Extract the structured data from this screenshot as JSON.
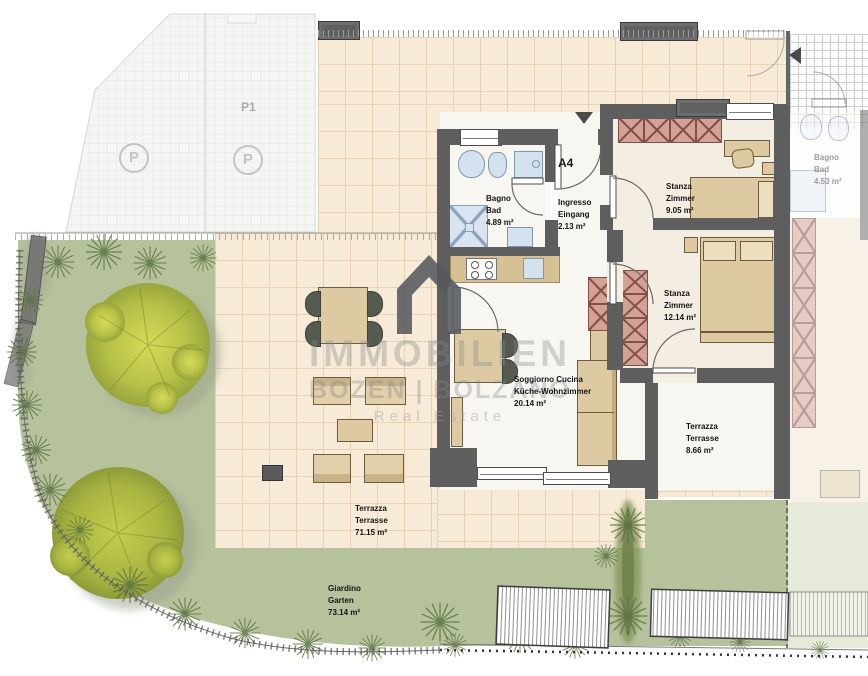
{
  "plan": {
    "unit_label": "A4",
    "parking": {
      "space_label": "P1",
      "icon_letter": "P"
    }
  },
  "watermark": {
    "brand_top": "IMMOBILIEN",
    "brand_bottom": "BOZEN | BOLZANO",
    "tagline": "Real Estate"
  },
  "rooms": {
    "bathroom": {
      "name_it": "Bagno",
      "name_de": "Bad",
      "area": "4.89 m²"
    },
    "entrance": {
      "name_it": "Ingresso",
      "name_de": "Eingang",
      "area": "2.13 m²"
    },
    "bedroom1": {
      "name_it": "Stanza",
      "name_de": "Zimmer",
      "area": "9.05 m²"
    },
    "bedroom2": {
      "name_it": "Stanza",
      "name_de": "Zimmer",
      "area": "12.14 m²"
    },
    "living": {
      "name_it": "Soggiorno Cucina",
      "name_de": "Küche-Wohnzimmer",
      "area": "20.14 m²"
    },
    "terrace_small": {
      "name_it": "Terrazza",
      "name_de": "Terrasse",
      "area": "8.66 m²"
    },
    "terrace_large": {
      "name_it": "Terrazza",
      "name_de": "Terrasse",
      "area": "71.15 m²"
    },
    "garden": {
      "name_it": "Giardino",
      "name_de": "Garten",
      "area": "73.14 m²"
    },
    "neighbor_bathroom": {
      "name_it": "Bagno",
      "name_de": "Bad",
      "area": "4.53 m²"
    }
  },
  "colors": {
    "wall": "#5e5e5e",
    "tile": "#f7ead6",
    "tile_line": "#e7d3b3",
    "garden_green": "#b6c29c",
    "neighbor_green": "#e5ead9",
    "tree_crown": "#c9cf50",
    "fixture_blue": "#d4e1ef",
    "furniture_beige": "#ddc9a2",
    "wardrobe_red": "#d4a295",
    "watermark_gray": "#84888c"
  }
}
